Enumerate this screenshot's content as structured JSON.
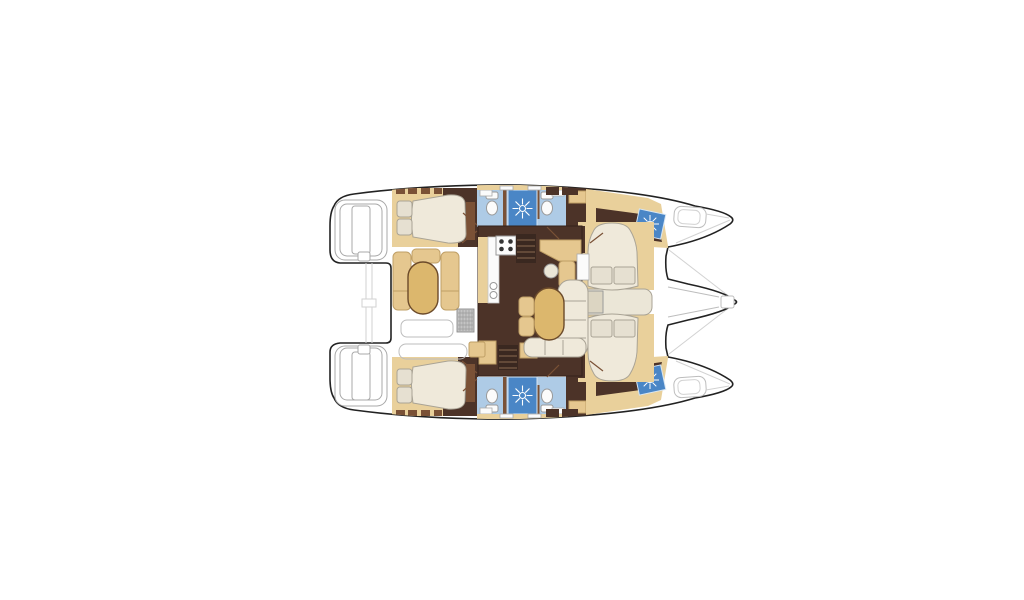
{
  "canvas": {
    "width": 1024,
    "height": 600,
    "background": "#ffffff"
  },
  "palette": {
    "white": "#ffffff",
    "outline": "#222222",
    "tan_floor": "#e9d09b",
    "tan_mid": "#e5c78f",
    "gold": "#dcb76d",
    "brown_dark": "#4c3328",
    "brown_mid": "#7a5136",
    "brown_deep": "#3a2820",
    "cream": "#efe9da",
    "pillow": "#e6e0d1",
    "blue_light": "#aecbe6",
    "blue_shower": "#4a86c6",
    "grate": "#c4c4c4",
    "fixture": "#fbfbfb",
    "band": "#ebe6d7",
    "nightstand": "#dcd5c2"
  },
  "plan": {
    "vessel": "catamaran-floorplan",
    "orientation": "bow-right",
    "hulls": 2,
    "features": [
      "stern-swim-platforms",
      "aft-cabin-double-beds",
      "heads-with-shower-roses",
      "cockpit-lounge-with-table",
      "galley-with-stove",
      "salon-dining-table",
      "companionway-steps",
      "forward-cabin-beds",
      "bow-trampoline",
      "bowsprit"
    ]
  }
}
